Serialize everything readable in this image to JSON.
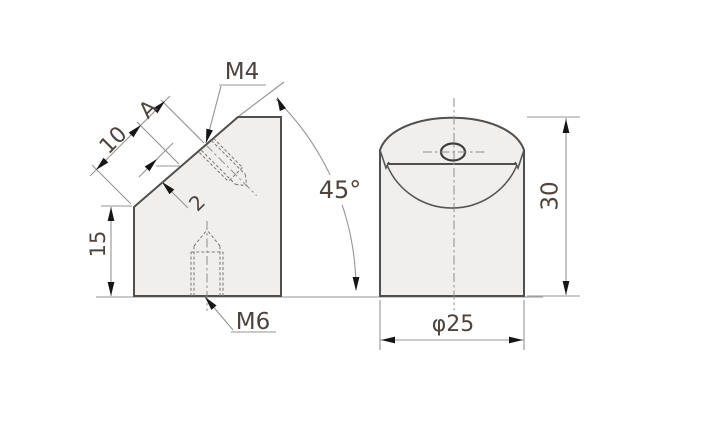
{
  "drawing": {
    "title": "45-degree cylindrical angle block, two-view technical drawing",
    "views": {
      "front_view": {
        "labels": {
          "m4_thread": "M4",
          "face_dim_a": "A",
          "face_dim_10": "10",
          "step_dim_2": "2",
          "angle_45": "45°",
          "height_15": "15",
          "m6_thread": "M6"
        }
      },
      "side_view": {
        "labels": {
          "height_30": "30",
          "diameter_25": "φ25"
        }
      }
    },
    "colors": {
      "background": "#ffffff",
      "part_fill": "#f0efed",
      "outline_stroke": "#4f4f4f",
      "thin_line": "#969491",
      "hidden_line": "#7e7c7a",
      "centerline": "#8f8d8b",
      "arrow": "#161616",
      "text": "#4d443e"
    }
  }
}
